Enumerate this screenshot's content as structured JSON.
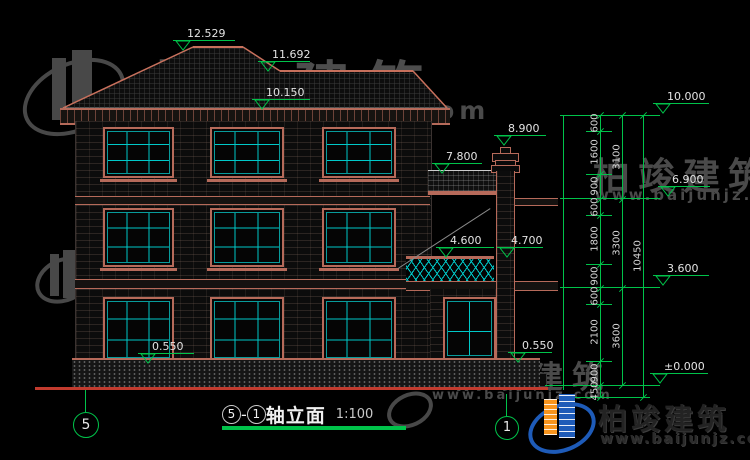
{
  "drawing": {
    "title": {
      "grid_start": "5",
      "separator": "-",
      "grid_end": "1",
      "axis_text": "轴立面",
      "scale": "1:100"
    },
    "grid_bubbles": {
      "left": "5",
      "right": "1"
    },
    "elevations": {
      "ridge": "12.529",
      "ridge2": "11.692",
      "eave": "10.150",
      "chimney_top": "8.900",
      "porch_eave": "7.800",
      "balcony_top": "4.600",
      "balcony_top2": "4.700",
      "sill_left": "0.550",
      "sill_right": "0.550",
      "ruler_top": "10.000",
      "ruler_third_floor": "6.900",
      "ruler_second_floor": "3.600",
      "ruler_ground": "±0.000"
    },
    "dim_segments": [
      "600",
      "1600",
      "900",
      "600",
      "1800",
      "900",
      "600",
      "2100",
      "900",
      "450"
    ],
    "dim_floors": [
      "3100",
      "3300",
      "3600"
    ],
    "dim_total": "10450"
  },
  "watermark": {
    "brand": "柏竣建筑",
    "url": "www.baijunjz.com"
  },
  "logo": {
    "brand": "柏竣建筑",
    "url": "www.baijunjz.com"
  },
  "colors": {
    "line_green": "#00c34a",
    "frame_salmon": "#b66a5a",
    "mullion_cyan": "#00c8c8",
    "ground_red": "#c23b2e",
    "logo_blue": "#1e5bb8",
    "logo_orange": "#f7941d"
  }
}
